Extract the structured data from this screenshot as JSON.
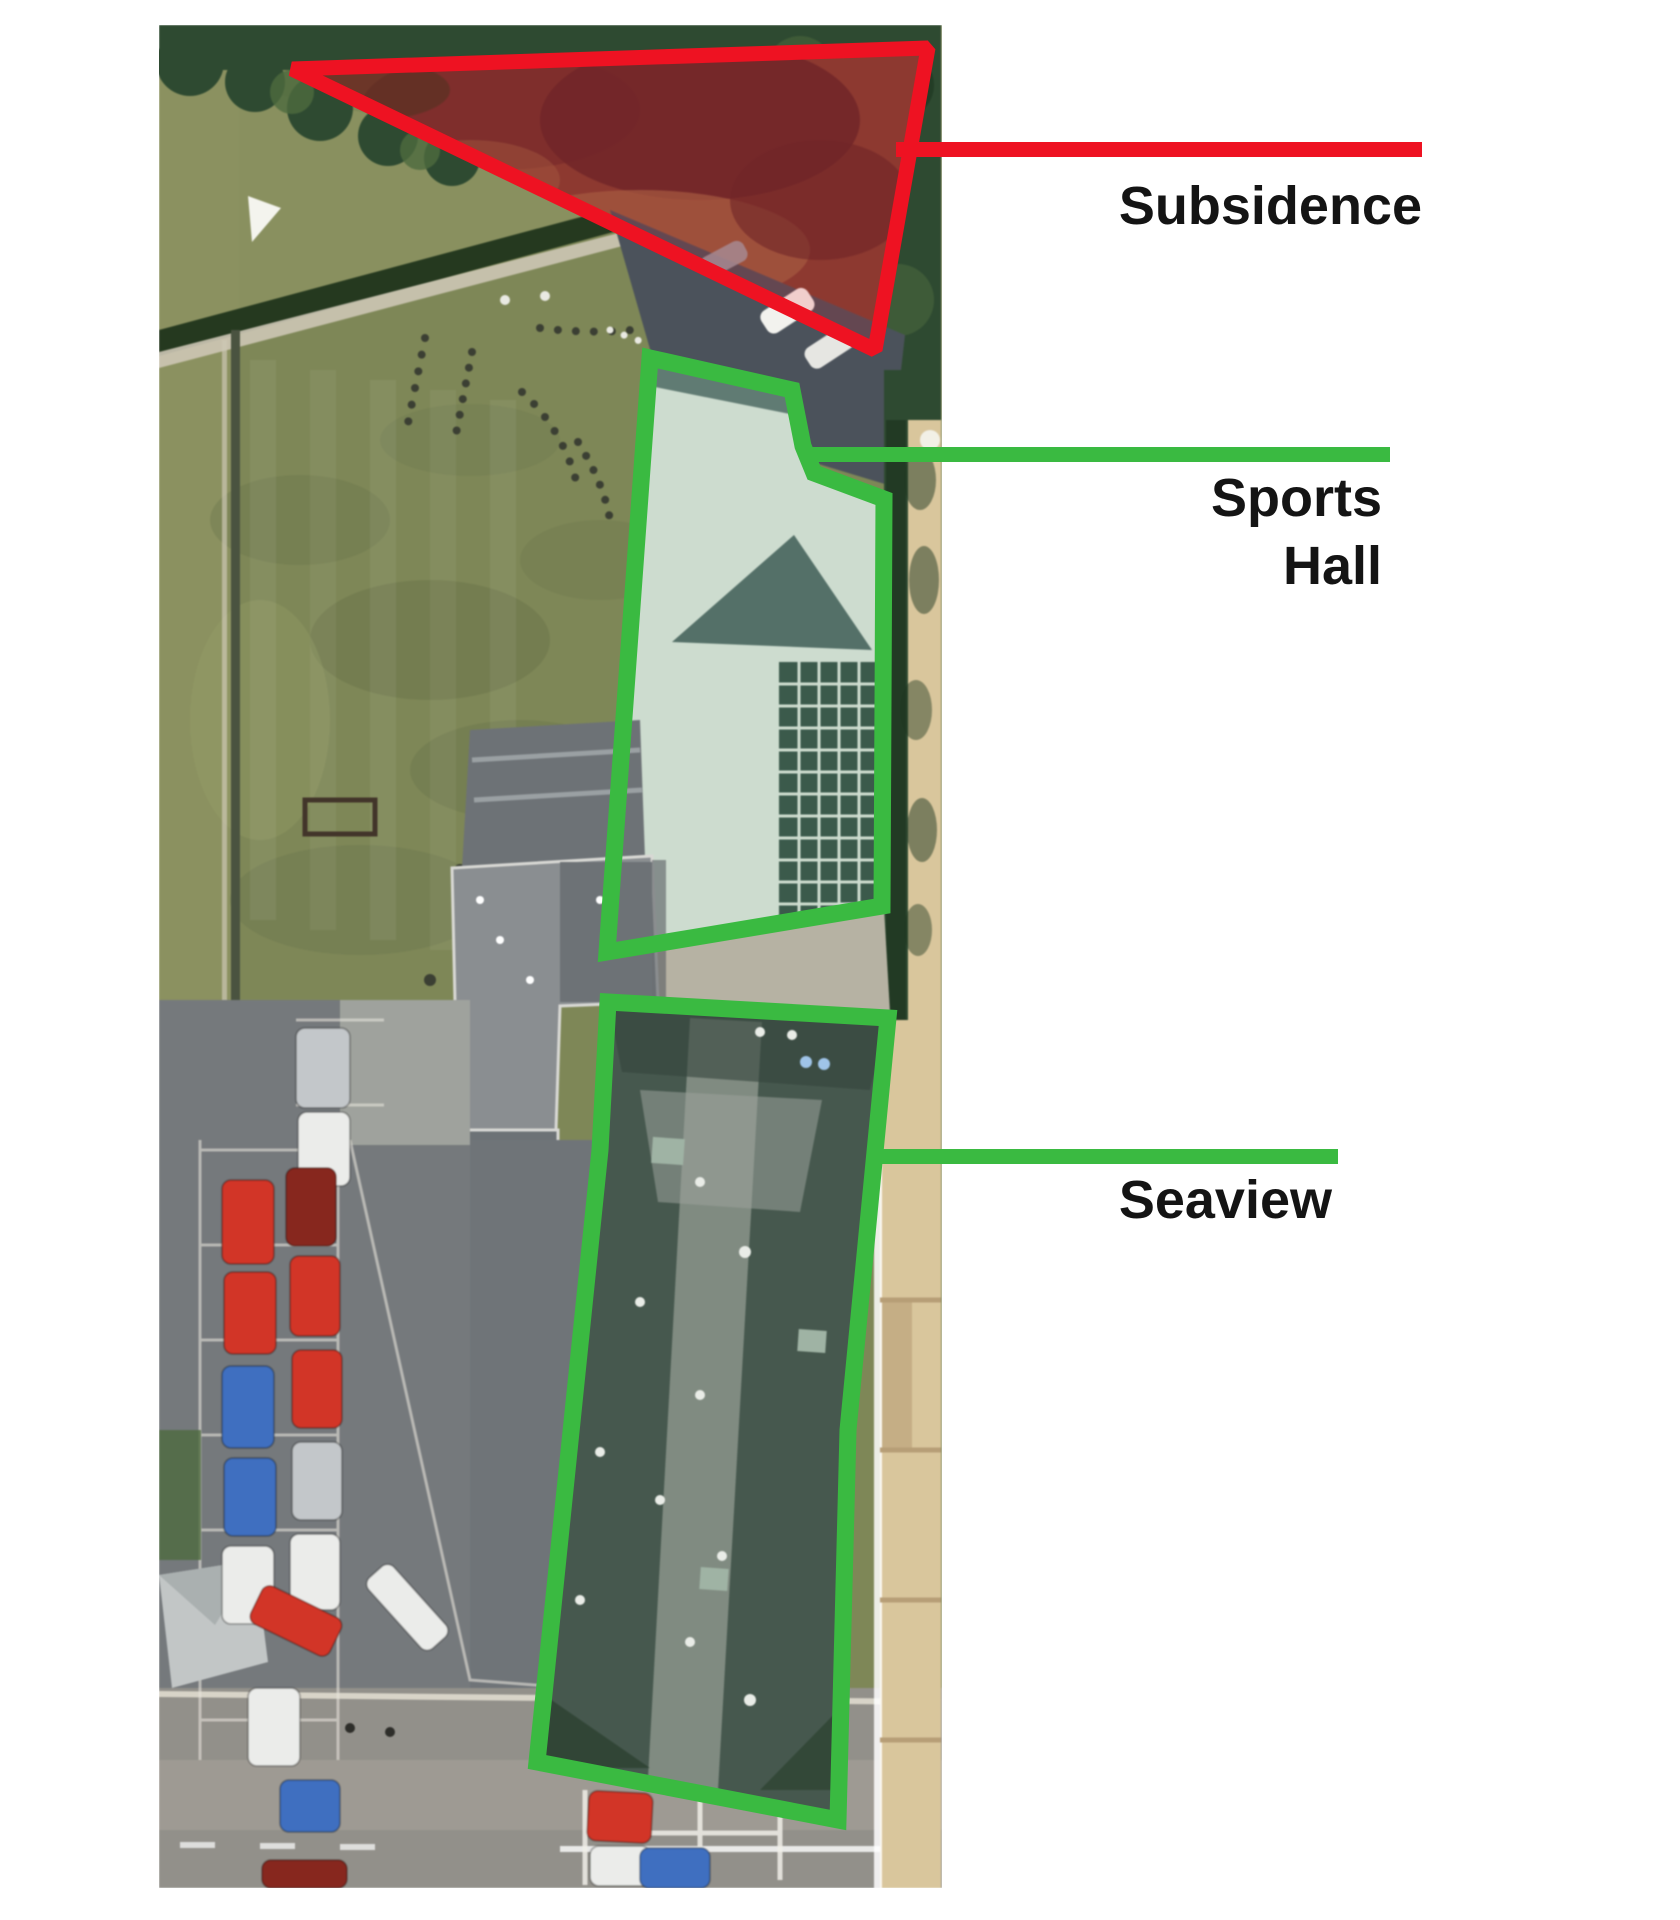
{
  "canvas": {
    "width": 1680,
    "height": 1920,
    "background": "#ffffff"
  },
  "annotations": {
    "palette": {
      "red": "#ee1222",
      "green": "#3aba41",
      "ink": "#141414"
    },
    "items": [
      {
        "id": "subsidence",
        "label": "Subsidence",
        "color": "red",
        "shape": "triangle-outline"
      },
      {
        "id": "sports_hall",
        "label": "Sports Hall",
        "label_lines": [
          "Sports",
          "Hall"
        ],
        "color": "green",
        "shape": "polygon-outline"
      },
      {
        "id": "seaview",
        "label": "Seaview",
        "color": "green",
        "shape": "polygon-outline"
      }
    ]
  },
  "photo": {
    "kind": "aerial-photograph",
    "palette": {
      "grass": "#7e8757",
      "grassDark": "#68724a",
      "grassLight": "#99a169",
      "fieldStrip": "#8b9160",
      "trees": "#2e4a31",
      "treesLight": "#4d6a3e",
      "treesDark": "#203722",
      "scrub": "#7b4134",
      "scrubDark": "#59282a",
      "scrubLight": "#9a6847",
      "hedge": "#25391f",
      "pathLight": "#cdc7b5",
      "driveway": "#4b525b",
      "hallRoof": "#cddccf",
      "hallGable": "#547068",
      "solar": "#3b5a4b",
      "walk": "#b6b2a3",
      "greyRoof": "#8a8e91",
      "greyRoofDark": "#6d7276",
      "seaRoof": "#46584e",
      "seaRoofLight": "#8f998f",
      "carpark": "#75797c",
      "roadA": "#92908a",
      "roadB": "#a6a29a",
      "tan": "#d9c69c",
      "tanDark": "#b79e77",
      "lineWhite": "#edeae0",
      "carRed": "#d23527",
      "carBlue": "#3f6fc0",
      "carWhite": "#ebecea",
      "carSilver": "#c3c7ca",
      "carDarkRed": "#87271e"
    }
  }
}
